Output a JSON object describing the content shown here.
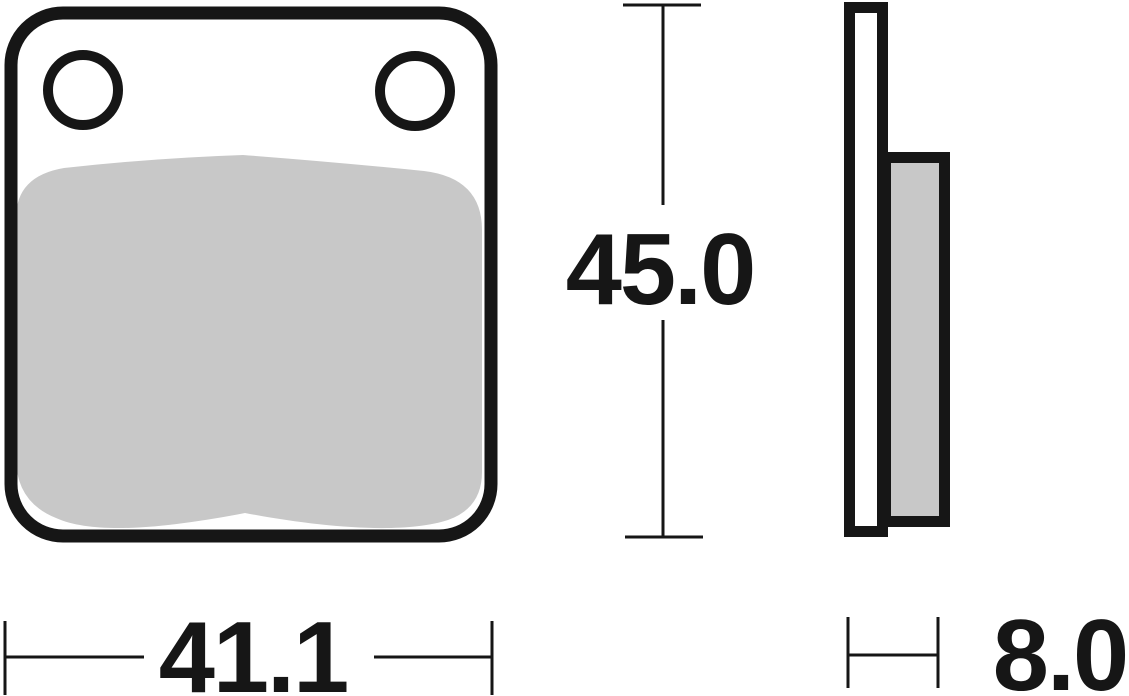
{
  "dimensions": {
    "front_width": "41.1",
    "front_height": "45.0",
    "side_thickness": "8.0"
  },
  "colors": {
    "line": "#161616",
    "friction_material": "#c8c8c8",
    "background": "#ffffff"
  }
}
